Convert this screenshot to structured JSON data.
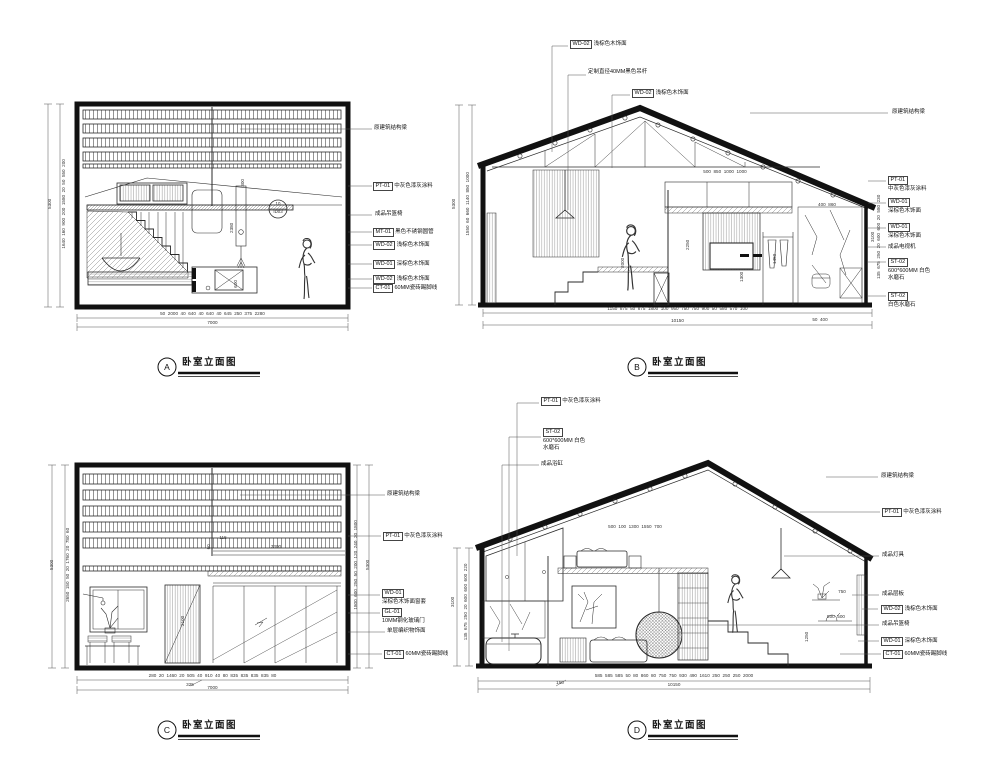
{
  "sheet": {
    "background": "#ffffff",
    "line_color": "#2a2a2a"
  },
  "drawings": {
    "A": {
      "tag": "A",
      "title": "卧室立面图",
      "callouts": [
        {
          "code": "",
          "text": "原建筑结构梁"
        },
        {
          "code": "PT-01",
          "text": "中灰色漆灰涂料"
        },
        {
          "code": "",
          "text": "成品吊篮椅"
        },
        {
          "code": "MT-01",
          "text": "黑色不锈钢圆管"
        },
        {
          "code": "WD-02",
          "text": "浅棕色木饰面"
        },
        {
          "code": "WD-01",
          "text": "深棕色木饰面"
        },
        {
          "code": "WD-02",
          "text": "浅棕色木饰面"
        },
        {
          "code": "CT-01",
          "text": "60MM瓷砖踢脚线"
        }
      ],
      "detail_bubble": {
        "top": "10",
        "bottom": "ID03"
      },
      "dims_left": [
        "1640",
        "160",
        "900",
        "200",
        "1580",
        "20",
        "50",
        "550",
        "200"
      ],
      "dims_left_total": "5300",
      "dims_bottom": [
        "50",
        "2000",
        "40",
        "640",
        "40",
        "640",
        "40",
        "645",
        "250",
        "375",
        "2280"
      ],
      "dims_bottom_total": "7000",
      "interior_dims": [
        "300",
        "2380",
        "600"
      ]
    },
    "B": {
      "tag": "B",
      "title": "卧室立面图",
      "callouts_top": [
        {
          "code": "WD-02",
          "text": "浅棕色木饰面"
        },
        {
          "code": "",
          "text": "定制直径40MM黑色吊杆"
        },
        {
          "code": "WD-02",
          "text": "浅棕色木饰面"
        }
      ],
      "callout_beam": "原建筑结构梁",
      "callouts_right": [
        {
          "code": "PT-01",
          "text": "中灰色漆灰涂料"
        },
        {
          "code": "WD-01",
          "text": "深棕色木饰面"
        },
        {
          "code": "WD-01",
          "text": "深棕色木饰面"
        },
        {
          "code": "",
          "text": "成品电视机"
        },
        {
          "code": "ST-02",
          "text": "600*600MM 白色水磨石"
        },
        {
          "code": "ST-02",
          "text": "白色水磨石"
        }
      ],
      "dims_left": [
        "1550",
        "60",
        "660",
        "1140",
        "850",
        "1000"
      ],
      "dims_left_total": "5300",
      "dims_right": [
        "135",
        "675",
        "250",
        "20",
        "600",
        "600",
        "20",
        "580",
        "230"
      ],
      "dims_right_total": "3100",
      "dims_bottom": [
        "1150",
        "875",
        "50",
        "875",
        "1800",
        "100",
        "950",
        "750",
        "750",
        "900",
        "50",
        "580",
        "570",
        "100"
      ],
      "dims_bottom_sub": [
        "50",
        "400"
      ],
      "dims_bottom_total": "10150",
      "interior_dims_top": [
        "500",
        "850",
        "1000",
        "1000"
      ],
      "interior_dims_mid": [
        "400",
        "860"
      ],
      "interior_dims_v": [
        "2250",
        "1450",
        "1300",
        "2000"
      ]
    },
    "C": {
      "tag": "C",
      "title": "卧室立面图",
      "callouts": [
        {
          "code": "",
          "text": "原建筑结构梁"
        },
        {
          "code": "PT-01",
          "text": "中灰色漆灰涂料"
        },
        {
          "code": "WD-01",
          "text": "深棕色木饰面窗套"
        },
        {
          "code": "GL-01",
          "text": "10MM钢化玻璃门"
        },
        {
          "code": "",
          "text": "单层编织物饰面"
        },
        {
          "code": "CT-01",
          "text": "60MM瓷砖踢脚线"
        }
      ],
      "dims_left": [
        "2650",
        "150",
        "50",
        "20",
        "1760",
        "20",
        "780",
        "60"
      ],
      "dims_left_total": "5300",
      "dims_right": [
        "1800",
        "600",
        "250",
        "50",
        "200",
        "120",
        "240",
        "20",
        "1800"
      ],
      "dims_right_total": "5300",
      "dims_bottom": [
        "280",
        "20",
        "1460",
        "20",
        "505",
        "40",
        "910",
        "40",
        "80",
        "835",
        "835",
        "835",
        "835",
        "80"
      ],
      "dims_bottom_sub": "325",
      "dims_bottom_total": "7000",
      "interior_dims": [
        "115",
        "3300",
        "60",
        "2100"
      ]
    },
    "D": {
      "tag": "D",
      "title": "卧室立面图",
      "callouts_left": [
        {
          "code": "PT-01",
          "text": "中灰色漆灰涂料"
        },
        {
          "code": "ST-02",
          "text": "600*600MM 白色水磨石"
        },
        {
          "code": "",
          "text": "成品浴缸"
        }
      ],
      "callouts_right": [
        {
          "code": "",
          "text": "原建筑结构梁"
        },
        {
          "code": "PT-01",
          "text": "中灰色漆灰涂料"
        },
        {
          "code": "",
          "text": "成品灯具"
        },
        {
          "code": "",
          "text": "成品层板"
        },
        {
          "code": "WD-02",
          "text": "浅棕色木饰面"
        },
        {
          "code": "",
          "text": "成品吊篮椅"
        },
        {
          "code": "WD-01",
          "text": "深棕色木饰面"
        },
        {
          "code": "CT-01",
          "text": "60MM瓷砖踢脚线"
        }
      ],
      "dims_left": [
        "135",
        "675",
        "250",
        "20",
        "600",
        "600",
        "600",
        "220"
      ],
      "dims_left_total": "3100",
      "dims_bottom": [
        "585",
        "585",
        "585",
        "50",
        "80",
        "860",
        "80",
        "750",
        "750",
        "930",
        "490",
        "1610",
        "250",
        "250",
        "250",
        "2000"
      ],
      "dims_bottom_sub": "150",
      "dims_bottom_total": "10150",
      "interior_dims_top": [
        "500",
        "100",
        "1300",
        "1550",
        "700"
      ],
      "interior_dims_right": [
        "750",
        "500  500",
        "1250"
      ]
    }
  }
}
